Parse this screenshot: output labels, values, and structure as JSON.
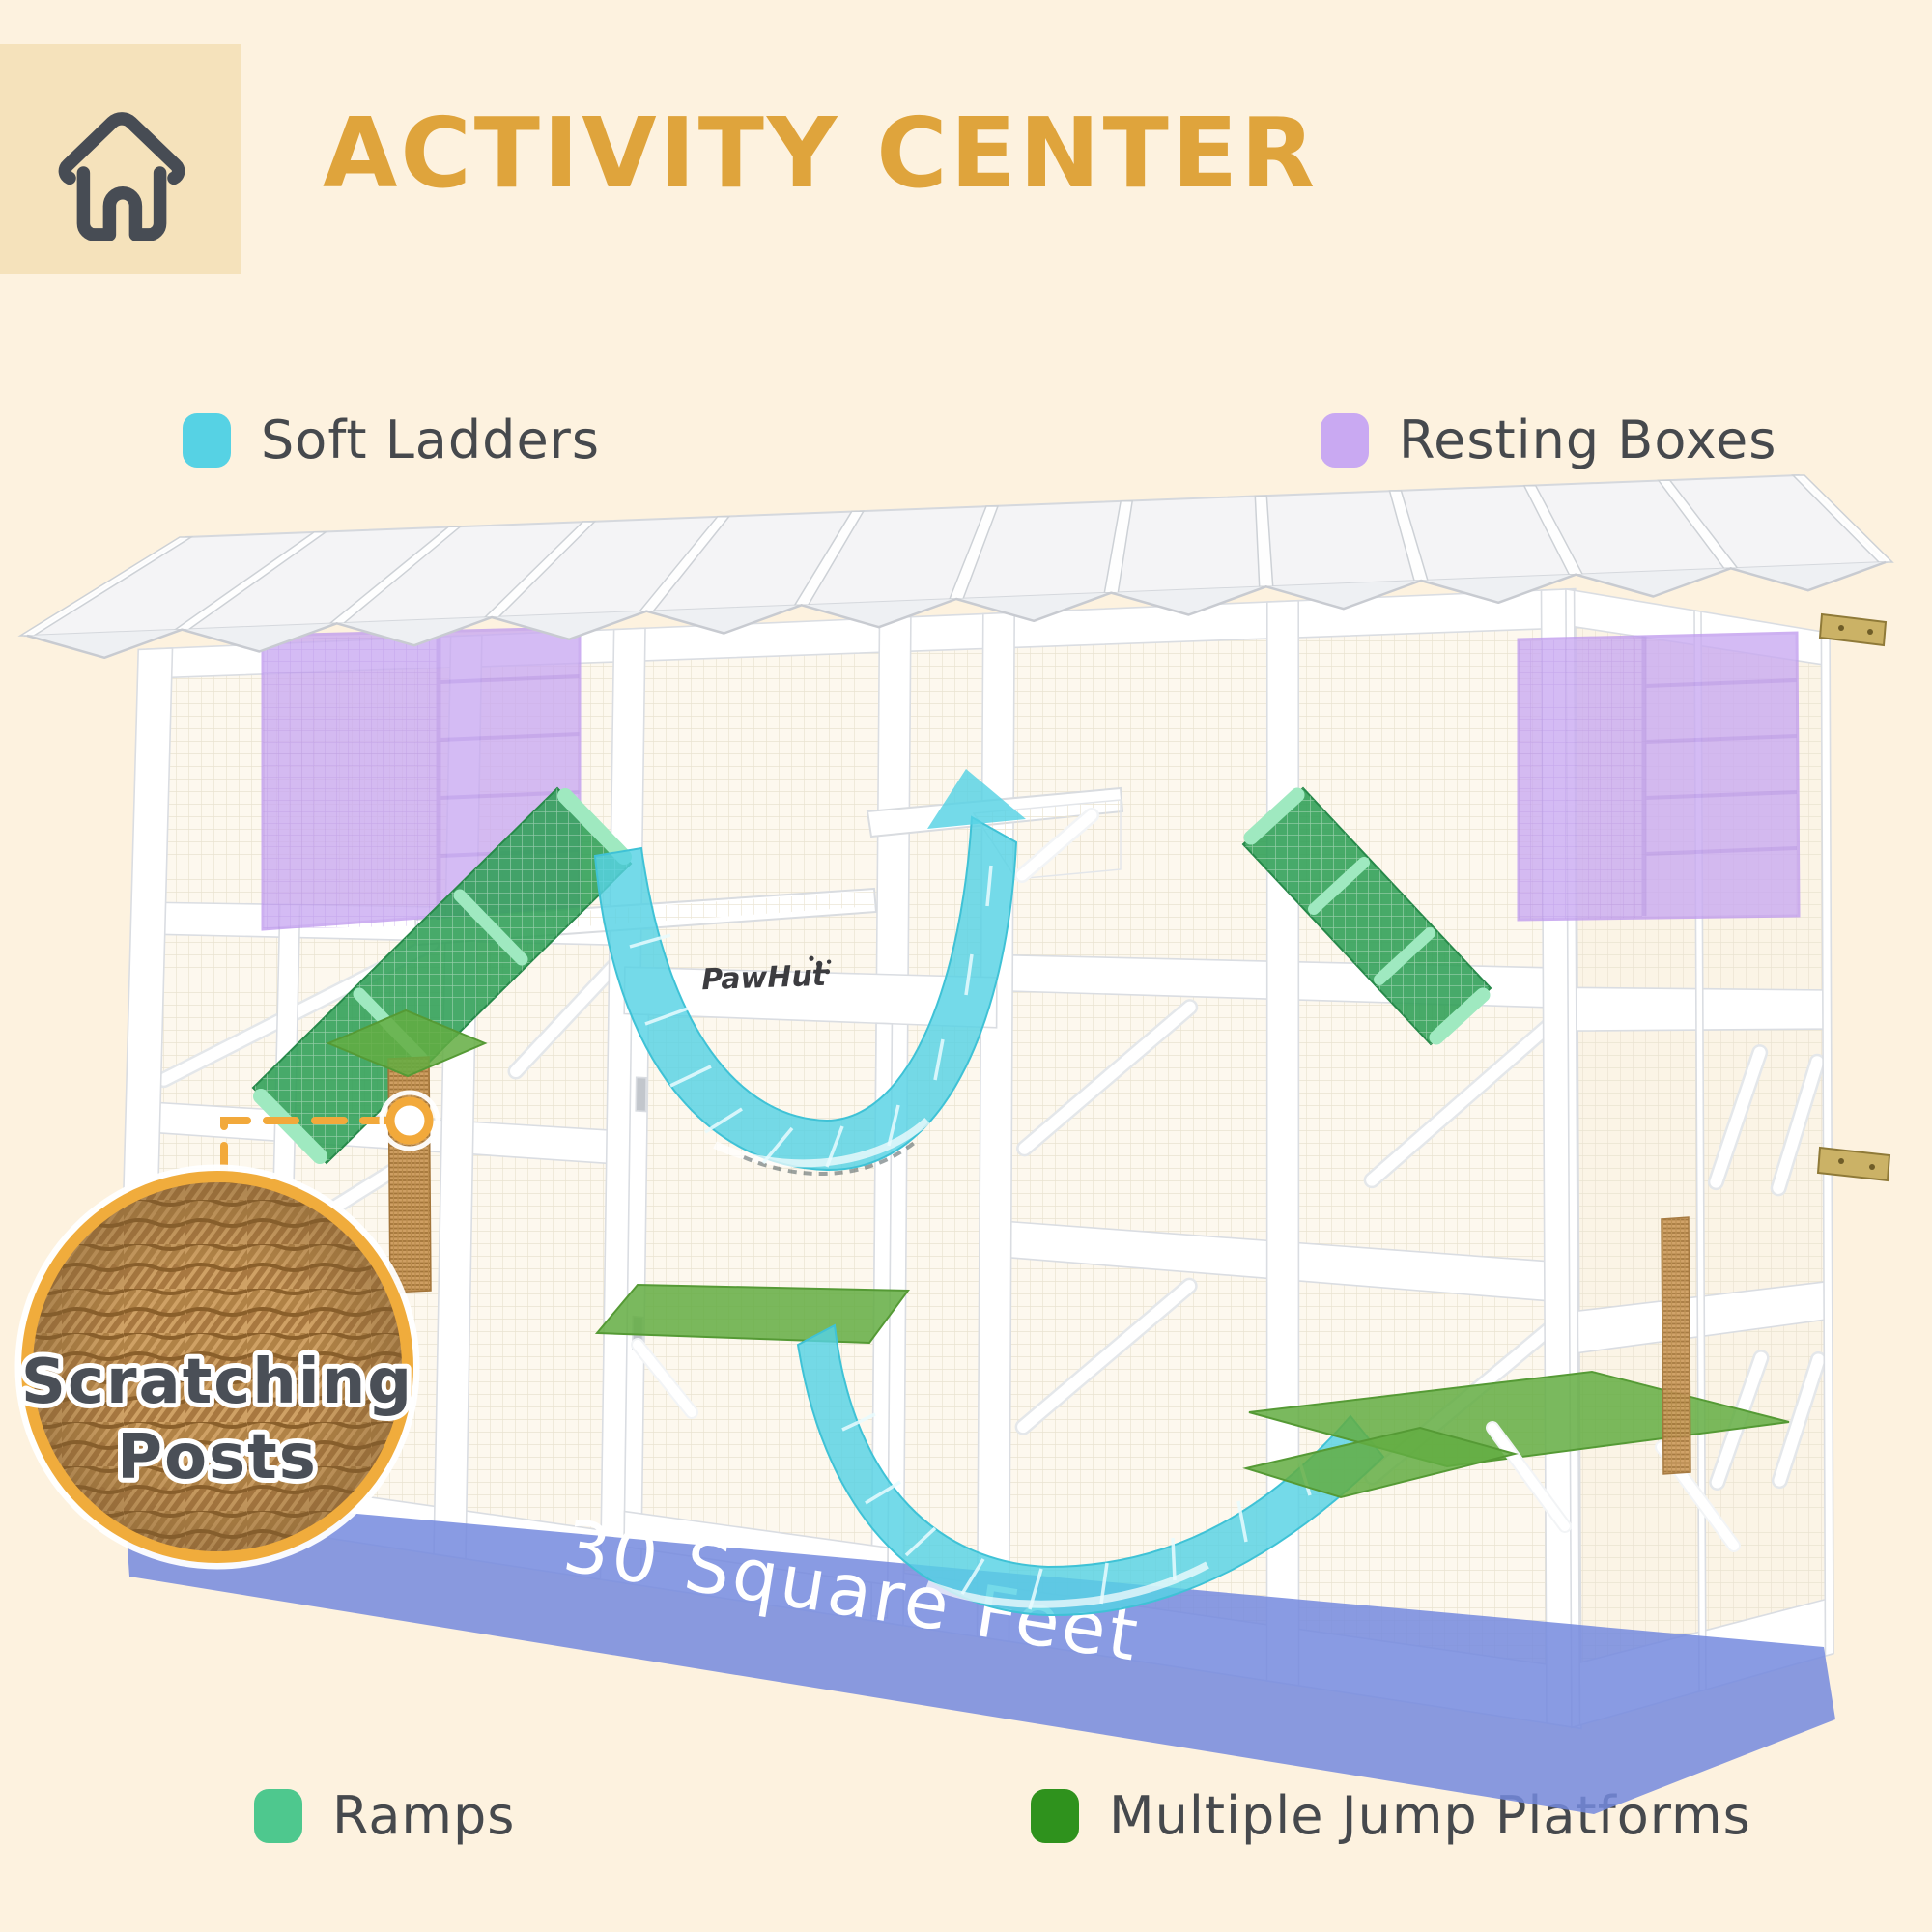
{
  "header": {
    "title": "ACTIVITY CENTER",
    "title_color": "#dfa43c",
    "tile_color": "#f5e2bb"
  },
  "legend": {
    "items": [
      {
        "id": "soft-ladders",
        "label": "Soft Ladders",
        "color": "#56d2e4"
      },
      {
        "id": "resting-boxes",
        "label": "Resting Boxes",
        "color": "#c9a9f2"
      },
      {
        "id": "ramps",
        "label": "Ramps",
        "color": "#4ec88e"
      },
      {
        "id": "jump-platforms",
        "label": "Multiple Jump Platforms",
        "color": "#2f921d"
      }
    ]
  },
  "callout": {
    "line1": "Scratching",
    "line2": "Posts",
    "ring_color": "#f0ac3c"
  },
  "floor_label": {
    "text": "30 Square Feet",
    "color": "#7489de"
  },
  "brand": "PawHut"
}
